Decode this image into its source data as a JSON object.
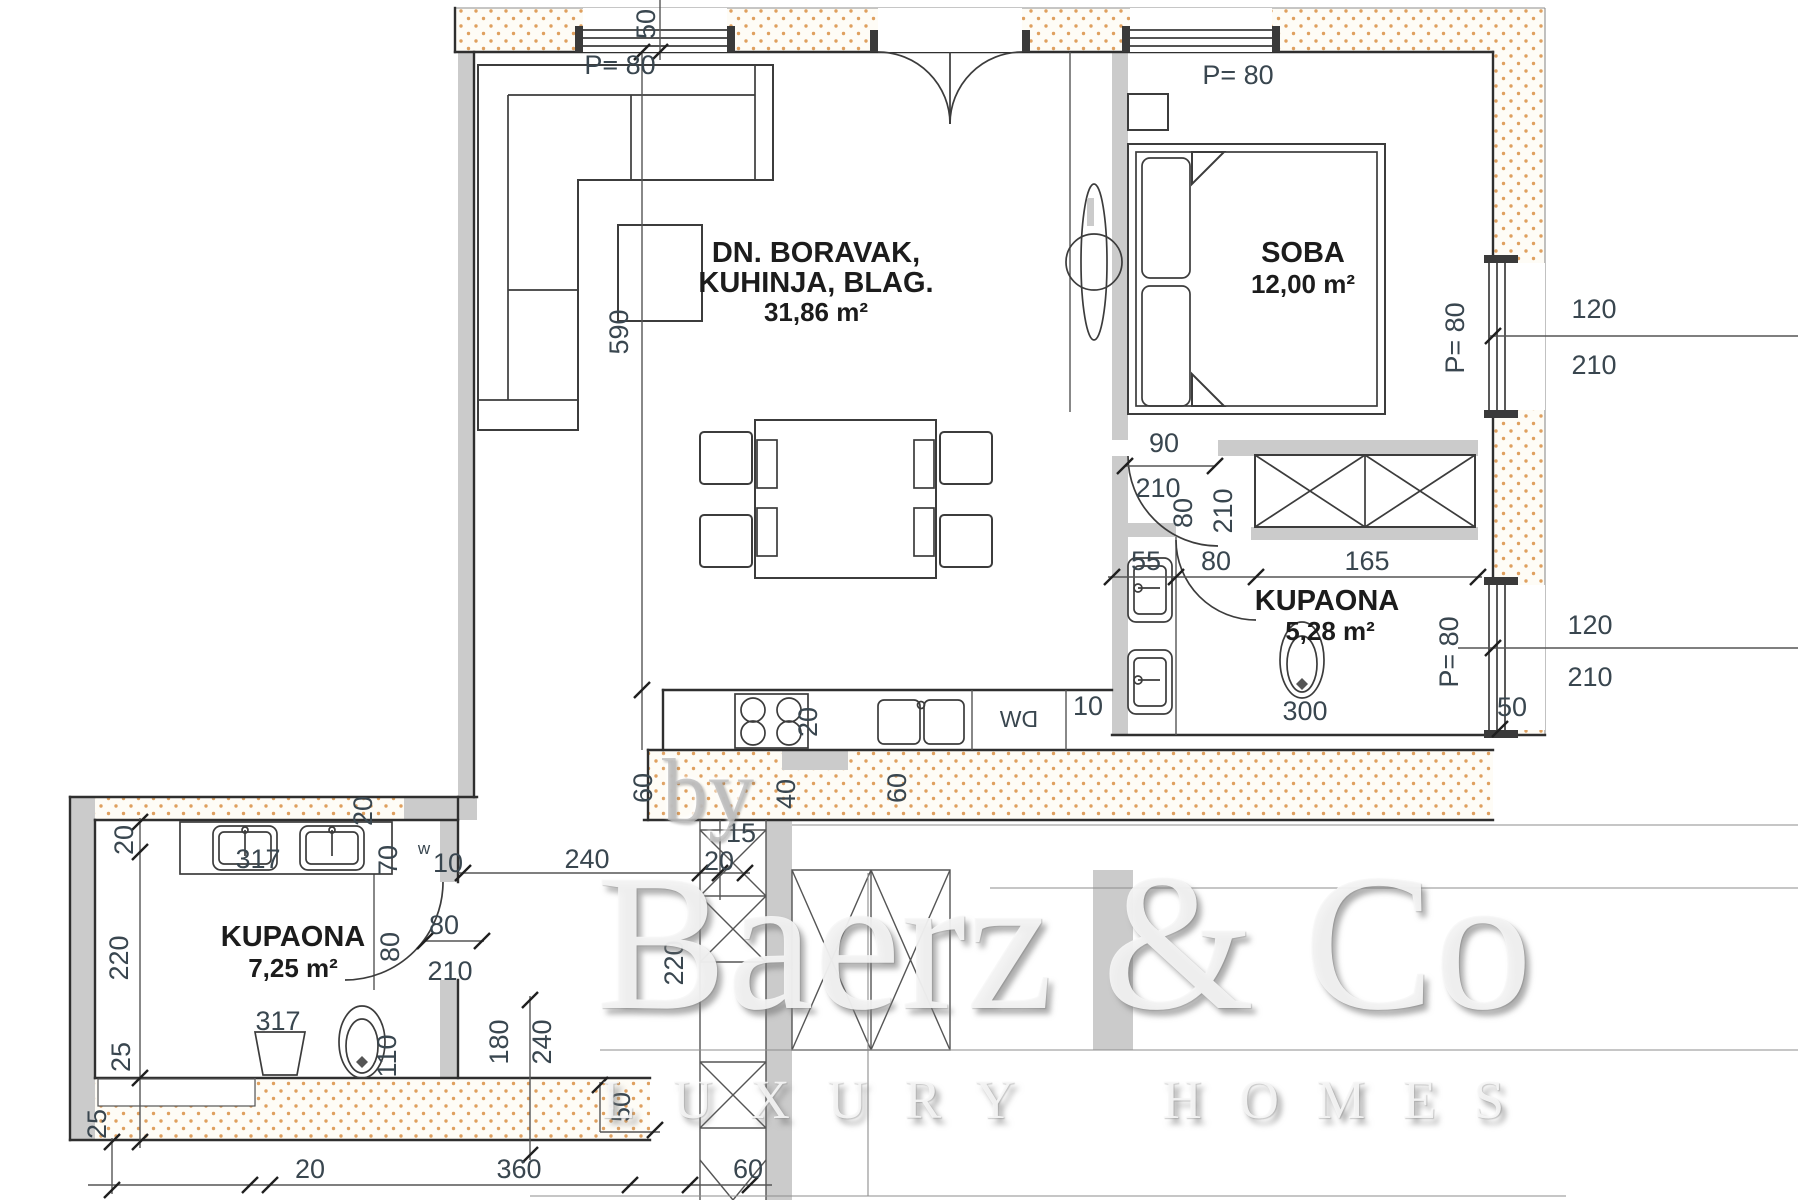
{
  "watermark": {
    "by": "by",
    "brand": "Baerz & Co",
    "tagline": "LUXURY HOMES"
  },
  "rooms": {
    "living": {
      "name1": "DN. BORAVAK,",
      "name2": "KUHINJA, BLAG.",
      "area": "31,86 m²"
    },
    "bedroom": {
      "name": "SOBA",
      "area": "12,00 m²"
    },
    "bath1": {
      "name": "KUPAONA",
      "area": "5,28 m²"
    },
    "bath2": {
      "name": "KUPAONA",
      "area": "7,25 m²"
    }
  },
  "windows": {
    "top_living": "P= 80",
    "top_bedroom": "P= 80",
    "right_bedroom": "P= 80",
    "right_bedroom_w": "120",
    "right_bedroom_h": "210",
    "right_bath": "P= 80",
    "right_bath_w": "120",
    "right_bath_h": "210"
  },
  "doors": {
    "bedroom_w": "90",
    "bedroom_h": "210",
    "bath1_w": "80",
    "bath1_h": "210",
    "bath1_clear": "80",
    "bath2_w": "80",
    "bath2_h": "210",
    "bath2_jamb": "80"
  },
  "dims": {
    "top_window": "50",
    "living_depth": "590",
    "kitchen_niche": "20",
    "balcony_left": "60",
    "balcony_mid": "40",
    "balcony_right": "60",
    "bottom_15": "15",
    "bottom_20": "20",
    "corridor": "240",
    "shaft_depth": "220",
    "closet": "55",
    "bath1_width": "165",
    "closet_gap": "10",
    "right_corner": "50",
    "link_wall": "20",
    "lower_top": "20",
    "lower_depth": "220",
    "lower_ledge": "25",
    "lower_edge": "25",
    "vanity_width": "317",
    "vanity_side": "70",
    "vanity_gap": "10",
    "floor_width": "317",
    "toilet_side": "110",
    "toilet_code": "300",
    "step_a": "180",
    "step_b": "240",
    "step_c": "50",
    "base_20": "20",
    "base_360": "360",
    "base_60": "60"
  },
  "appliances": {
    "dishwasher": "DW",
    "washer": "w"
  },
  "colors": {
    "dots": "#dfa05f",
    "walls": "#cbcbcb",
    "dim_text": "#39464f",
    "room_text": "#1c1c1c"
  }
}
